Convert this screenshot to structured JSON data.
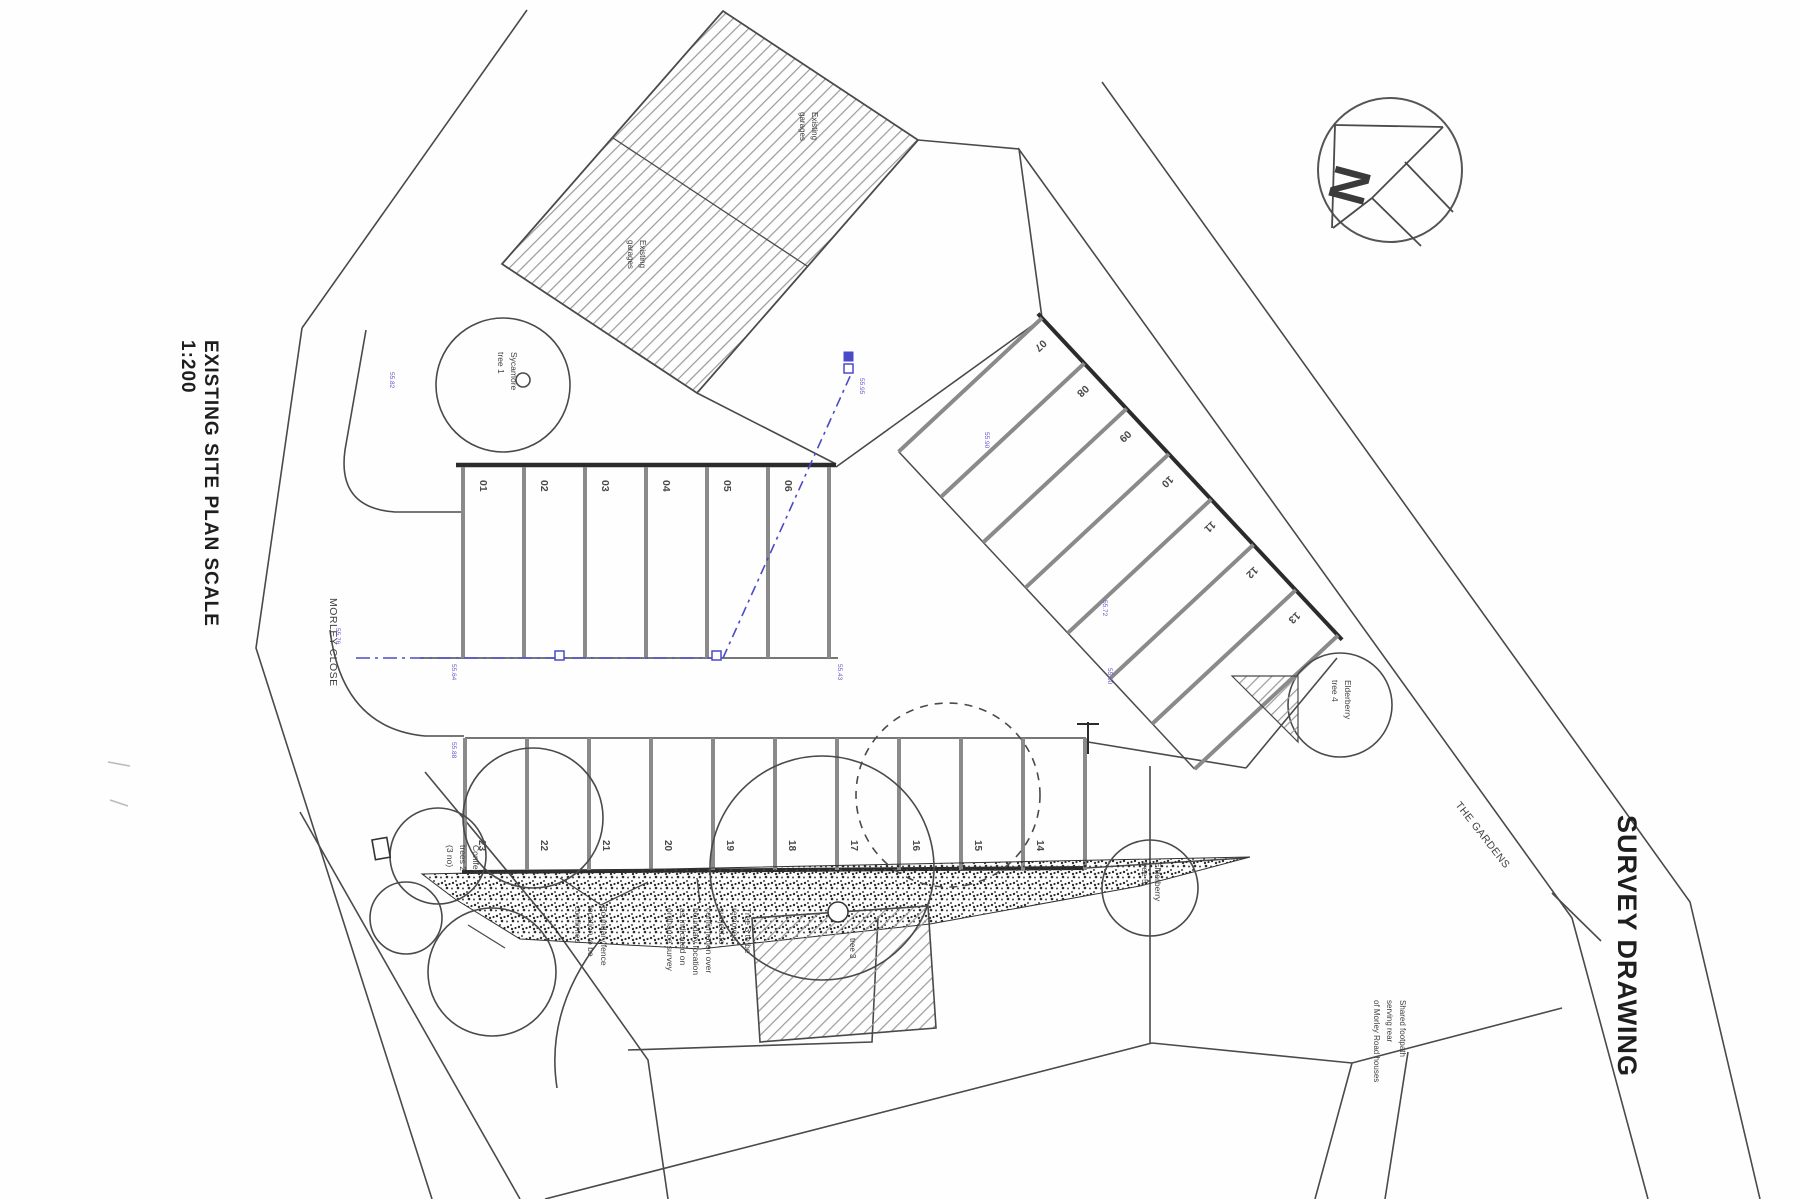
{
  "titles": {
    "left_title": "EXISTING SITE PLAN SCALE",
    "left_scale": "1:200",
    "right_title": "SURVEY DRAWING"
  },
  "compass": {
    "north_label": "N"
  },
  "roads": {
    "morley_close": "MORLEY CLOSE",
    "the_gardens": "THE GARDENS"
  },
  "buildings": {
    "garage_note_1": [
      "Existing",
      "garages"
    ],
    "garage_note_2": [
      "Existing",
      "garages"
    ],
    "workshop_tree_label": "tree 3"
  },
  "trees": {
    "sycamore": [
      "Sycamore",
      "tree 1"
    ],
    "conifer": [
      "Conifer",
      "trees 2",
      "(3 no)"
    ],
    "elderberry_mid": [
      "Elderberry",
      "tree 4"
    ],
    "elderberry_low": [
      "Elderberry",
      "tree 5"
    ]
  },
  "annotations": {
    "boundary_fence": [
      "Boundary fence",
      "location to be",
      "confirmed"
    ],
    "tree3_note": [
      "Tree 3 to be",
      "removed",
      "subject to",
      "confirmation over",
      "boundary location",
      "as indicated on",
      "ordnance survey"
    ],
    "footpath_note": [
      "Shared footpath",
      "serving rear",
      "of Morley Road houses"
    ]
  },
  "parking": {
    "row1": [
      "01",
      "02",
      "03",
      "04",
      "05",
      "06"
    ],
    "row2": [
      "07",
      "08",
      "09",
      "10",
      "11",
      "12",
      "13"
    ],
    "row3": [
      "23",
      "22",
      "21",
      "20",
      "19",
      "18",
      "17",
      "16",
      "15",
      "14"
    ]
  },
  "levels": [
    "55.82",
    "55.64",
    "55.43",
    "55.88",
    "55.90",
    "55.72",
    "55.60",
    "55.95",
    "55.76"
  ],
  "colors": {
    "line": "#4a4a4a",
    "thick_line": "#2b2b2b",
    "utility_blue": "#4a4ac8",
    "level_purple": "#6a5acd"
  }
}
